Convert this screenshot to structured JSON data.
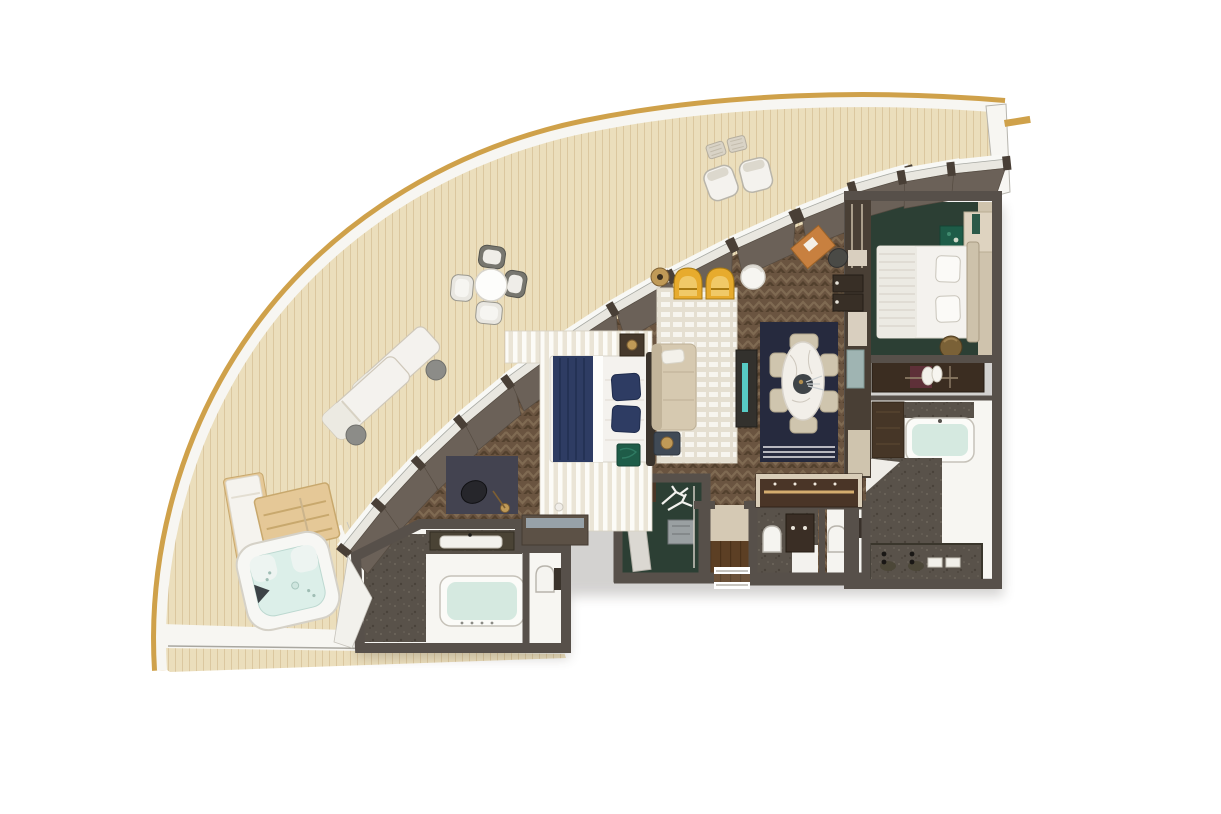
{
  "scene": {
    "type": "floor-plan",
    "view": "top-down 3D render",
    "subject": "Luxury suite floor plan with curved private terrace",
    "window_count": 13,
    "rooms": [
      {
        "name": "terrace",
        "features": [
          "curved plank deck with gold trim edge",
          "round outdoor dining table with 4 chairs",
          "two sun loungers with 2 round side tables",
          "two armchairs with rattan tables",
          "hot tub",
          "wooden step platform",
          "white daybed",
          "white deck ledge"
        ]
      },
      {
        "name": "living-room",
        "features": [
          "striped cream rug",
          "two yellow armchairs",
          "beige sofa with lumbar pillow",
          "white cylinder side table",
          "bronze floor lamp",
          "tv console with lit screen",
          "dark side table with lamp",
          "malachite stool"
        ]
      },
      {
        "name": "master-bedroom",
        "features": [
          "double bed with navy runner",
          "two navy pillows",
          "striped wood paneling",
          "nightstand with bronze lamp",
          "dresser with mirror",
          "desk with black chair and arc lamp"
        ]
      },
      {
        "name": "dining-area",
        "features": [
          "navy rug with white border stripes",
          "oval marble dining table with centerpiece",
          "six beige dining chairs",
          "sideboard with warm lighting",
          "corner desk with tan chair"
        ]
      },
      {
        "name": "walk-in-closet",
        "features": [
          "dark green floor",
          "white antler decor",
          "gray cabinet",
          "open door leaf"
        ]
      },
      {
        "name": "entry-corridor",
        "features": [
          "wood floor",
          "entry door threshold"
        ]
      },
      {
        "name": "guest-wc",
        "features": [
          "two toilets",
          "dark vanity with two faucets",
          "stone floor"
        ]
      },
      {
        "name": "master-bathroom",
        "features": [
          "bathtub with pale water",
          "vanity counter with basin",
          "separate toilet room",
          "stone shower area"
        ]
      },
      {
        "name": "second-bedroom",
        "features": [
          "double bed with white pillows",
          "pleated runner",
          "plant box on nightstand",
          "cream cabinet",
          "bronze ottoman",
          "wardrobe with hanging clothes"
        ]
      },
      {
        "name": "second-bathroom",
        "features": [
          "bathtub with pale water",
          "stone floor",
          "double vanity with black faucets",
          "dark cabinet"
        ]
      }
    ]
  },
  "colors": {
    "bg": "#ffffff",
    "gold": "#cfa14a",
    "deck": "#ebdebc",
    "deckLine": "#dbc79f",
    "rim": "#f7f6f2",
    "rimLine": "#b7b5ae",
    "floor": "#6a5440",
    "floorLight": "#7f6a52",
    "floorDark": "#52402d",
    "wall": "#57504a",
    "reveal": "#6b6158",
    "glass": "#e9e7e0",
    "sill": "#f8f8f5",
    "mull": "#493f36",
    "panel": "#eae4d6",
    "panelLight": "#fcfbf7",
    "rugCream": "#e5dfd1",
    "rugStripe": "#f7f5ef",
    "navyRug": "#262a3e",
    "navy": "#2e3c63",
    "navyDark": "#1f2c4d",
    "bedWhite": "#f4f2ee",
    "sofa": "#d6c9b0",
    "sofaDark": "#c2b49a",
    "chairBeige": "#cfc5ae",
    "yellow": "#e7ab2d",
    "yellowLight": "#f0c968",
    "yellowDark": "#a87a12",
    "marble": "#f2efe9",
    "bronze": "#c09a57",
    "bronzeDark": "#7d5f33",
    "green": "#2c3f34",
    "malachite": "#1e5c48",
    "stone": "#59524a",
    "stoneDot": "#6e675d",
    "aqua": "#d5e9e0",
    "hotAqua": "#dcefe9",
    "woodWarm": "#5c3f24",
    "woodTan": "#e5c897",
    "woodTanDark": "#c8a86d",
    "cream": "#ded3c0",
    "creamDark": "#b9ac94",
    "maroon": "#5e3038",
    "teal": "#5ad8d2",
    "darkFurn": "#3a332c",
    "slate": "#434350",
    "offWhite": "#efede8",
    "white": "#ffffff",
    "grayTable": "#8c8c88",
    "mirror": "#97a1a8"
  }
}
